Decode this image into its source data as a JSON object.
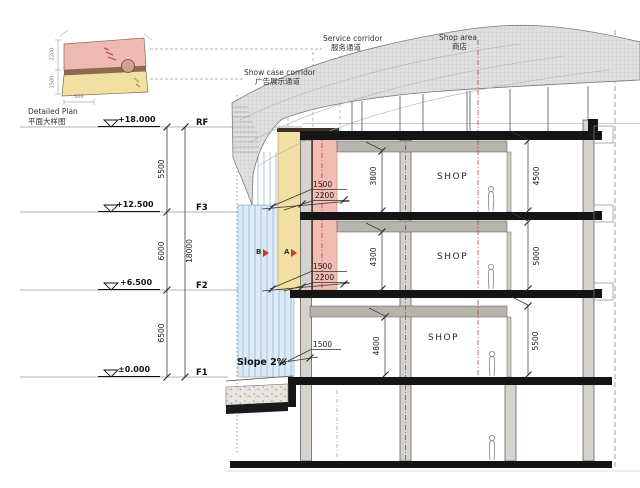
{
  "inset": {
    "title_en": "Detailed Plan",
    "title_zh": "平面大样图",
    "dims": {
      "left_top": "2200",
      "left_bottom": "1500",
      "bottom": "500"
    }
  },
  "callouts": {
    "service_corridor": {
      "en": "Service corridor",
      "zh": "服务通道"
    },
    "showcase_corridor": {
      "en": "Show case corridor",
      "zh": "广告展示通道"
    },
    "shop_area": {
      "en": "Shop area",
      "zh": "商店"
    }
  },
  "levels": [
    {
      "elevation": "+18.000",
      "name": "RF"
    },
    {
      "elevation": "+12.500",
      "name": "F3"
    },
    {
      "elevation": "+6.500",
      "name": "F2"
    },
    {
      "elevation": "±0.000",
      "name": "F1"
    }
  ],
  "dim_chain": {
    "rf_f3": "5500",
    "f3_f2": "6000",
    "f2_f1": "6500",
    "total": "18000"
  },
  "story_heights": {
    "left": [
      "3800",
      "4300",
      "4800"
    ],
    "right": [
      "4500",
      "5000",
      "5500"
    ]
  },
  "corridor_dims": {
    "f3": [
      "1500",
      "2200"
    ],
    "f2": [
      "1500",
      "2200"
    ],
    "f1": [
      "1500"
    ]
  },
  "rooms": {
    "shop": "SHOP"
  },
  "annotations": {
    "slope": "Slope 2%",
    "marker_a": "A",
    "marker_b": "B"
  },
  "colors": {
    "service_corridor": "#f1bcb4",
    "showcase_corridor": "#f2dfa2",
    "glazing": "#dcebf7",
    "roof": "#e0e0e0",
    "grid_red": "#b4443a"
  }
}
